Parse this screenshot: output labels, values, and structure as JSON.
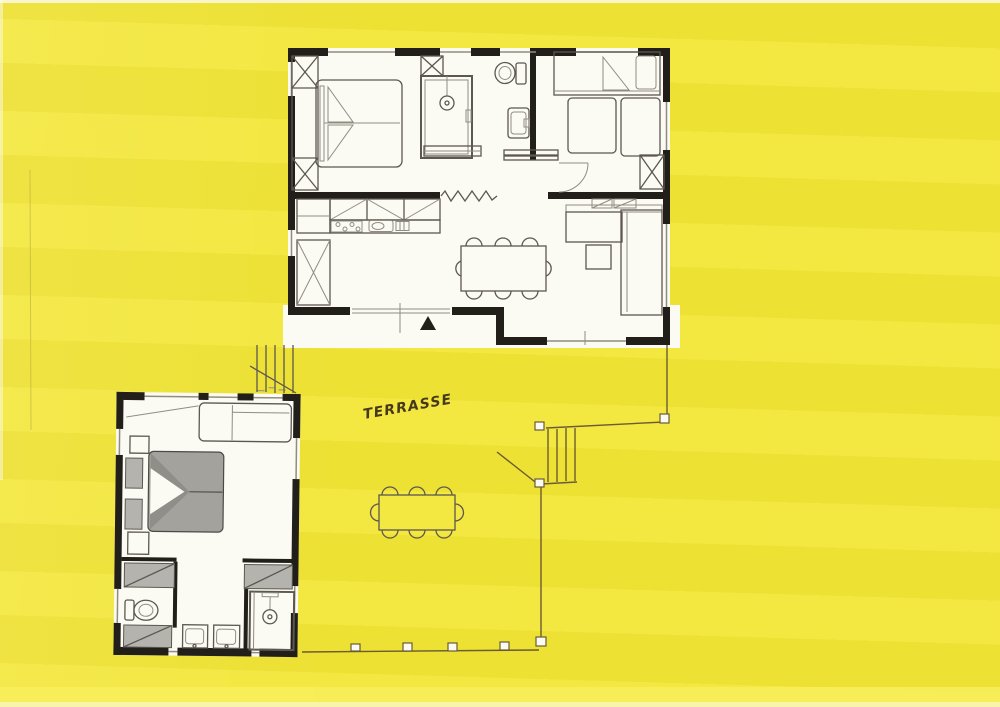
{
  "document": {
    "type": "scanned hand-drawn floor plan highlighted in yellow marker",
    "units": [
      "upper-unit",
      "lower-unit",
      "terrace"
    ]
  },
  "labels": {
    "terrace": "TERRASSE"
  },
  "colors": {
    "bg": "#f2e636",
    "bg_light": "#f7ee5c",
    "paper": "#fbfaf3",
    "wall": "#221f1a",
    "line": "#5c5850",
    "line_light": "#918c80",
    "shade": "#b4b3ae",
    "duvet": "#a3a29d",
    "duvet_dark": "#8f8e89",
    "terrace_line": "#6b5c33",
    "ink": "#453a1c"
  },
  "plan": {
    "upper_unit": {
      "rooms": [
        "bedroom",
        "shower-room",
        "wc",
        "second-bedroom",
        "kitchen",
        "living-dining"
      ],
      "furniture": [
        "double-bed",
        "wardrobes",
        "shower-stall",
        "toilet",
        "washbasin",
        "single-bed",
        "two-guest-beds",
        "kitchen-counter",
        "stove",
        "sink",
        "tall-cabinet",
        "dining-table",
        "eight-chairs",
        "corner-sofa",
        "side-table"
      ],
      "symbols": [
        "entrance-triangle",
        "zigzag-partition",
        "sliding-door",
        "door-swing-arc"
      ]
    },
    "lower_unit": {
      "rooms": [
        "bedroom",
        "bathroom"
      ],
      "furniture": [
        "gray-double-bed",
        "nightstands",
        "sofa",
        "closets",
        "toilet",
        "twin-washbasins",
        "shower"
      ]
    },
    "terrace": {
      "furniture": [
        "outdoor-table",
        "eight-chairs"
      ],
      "features": [
        "boundary-posts",
        "stairs-upper",
        "stairs-lower"
      ]
    }
  }
}
